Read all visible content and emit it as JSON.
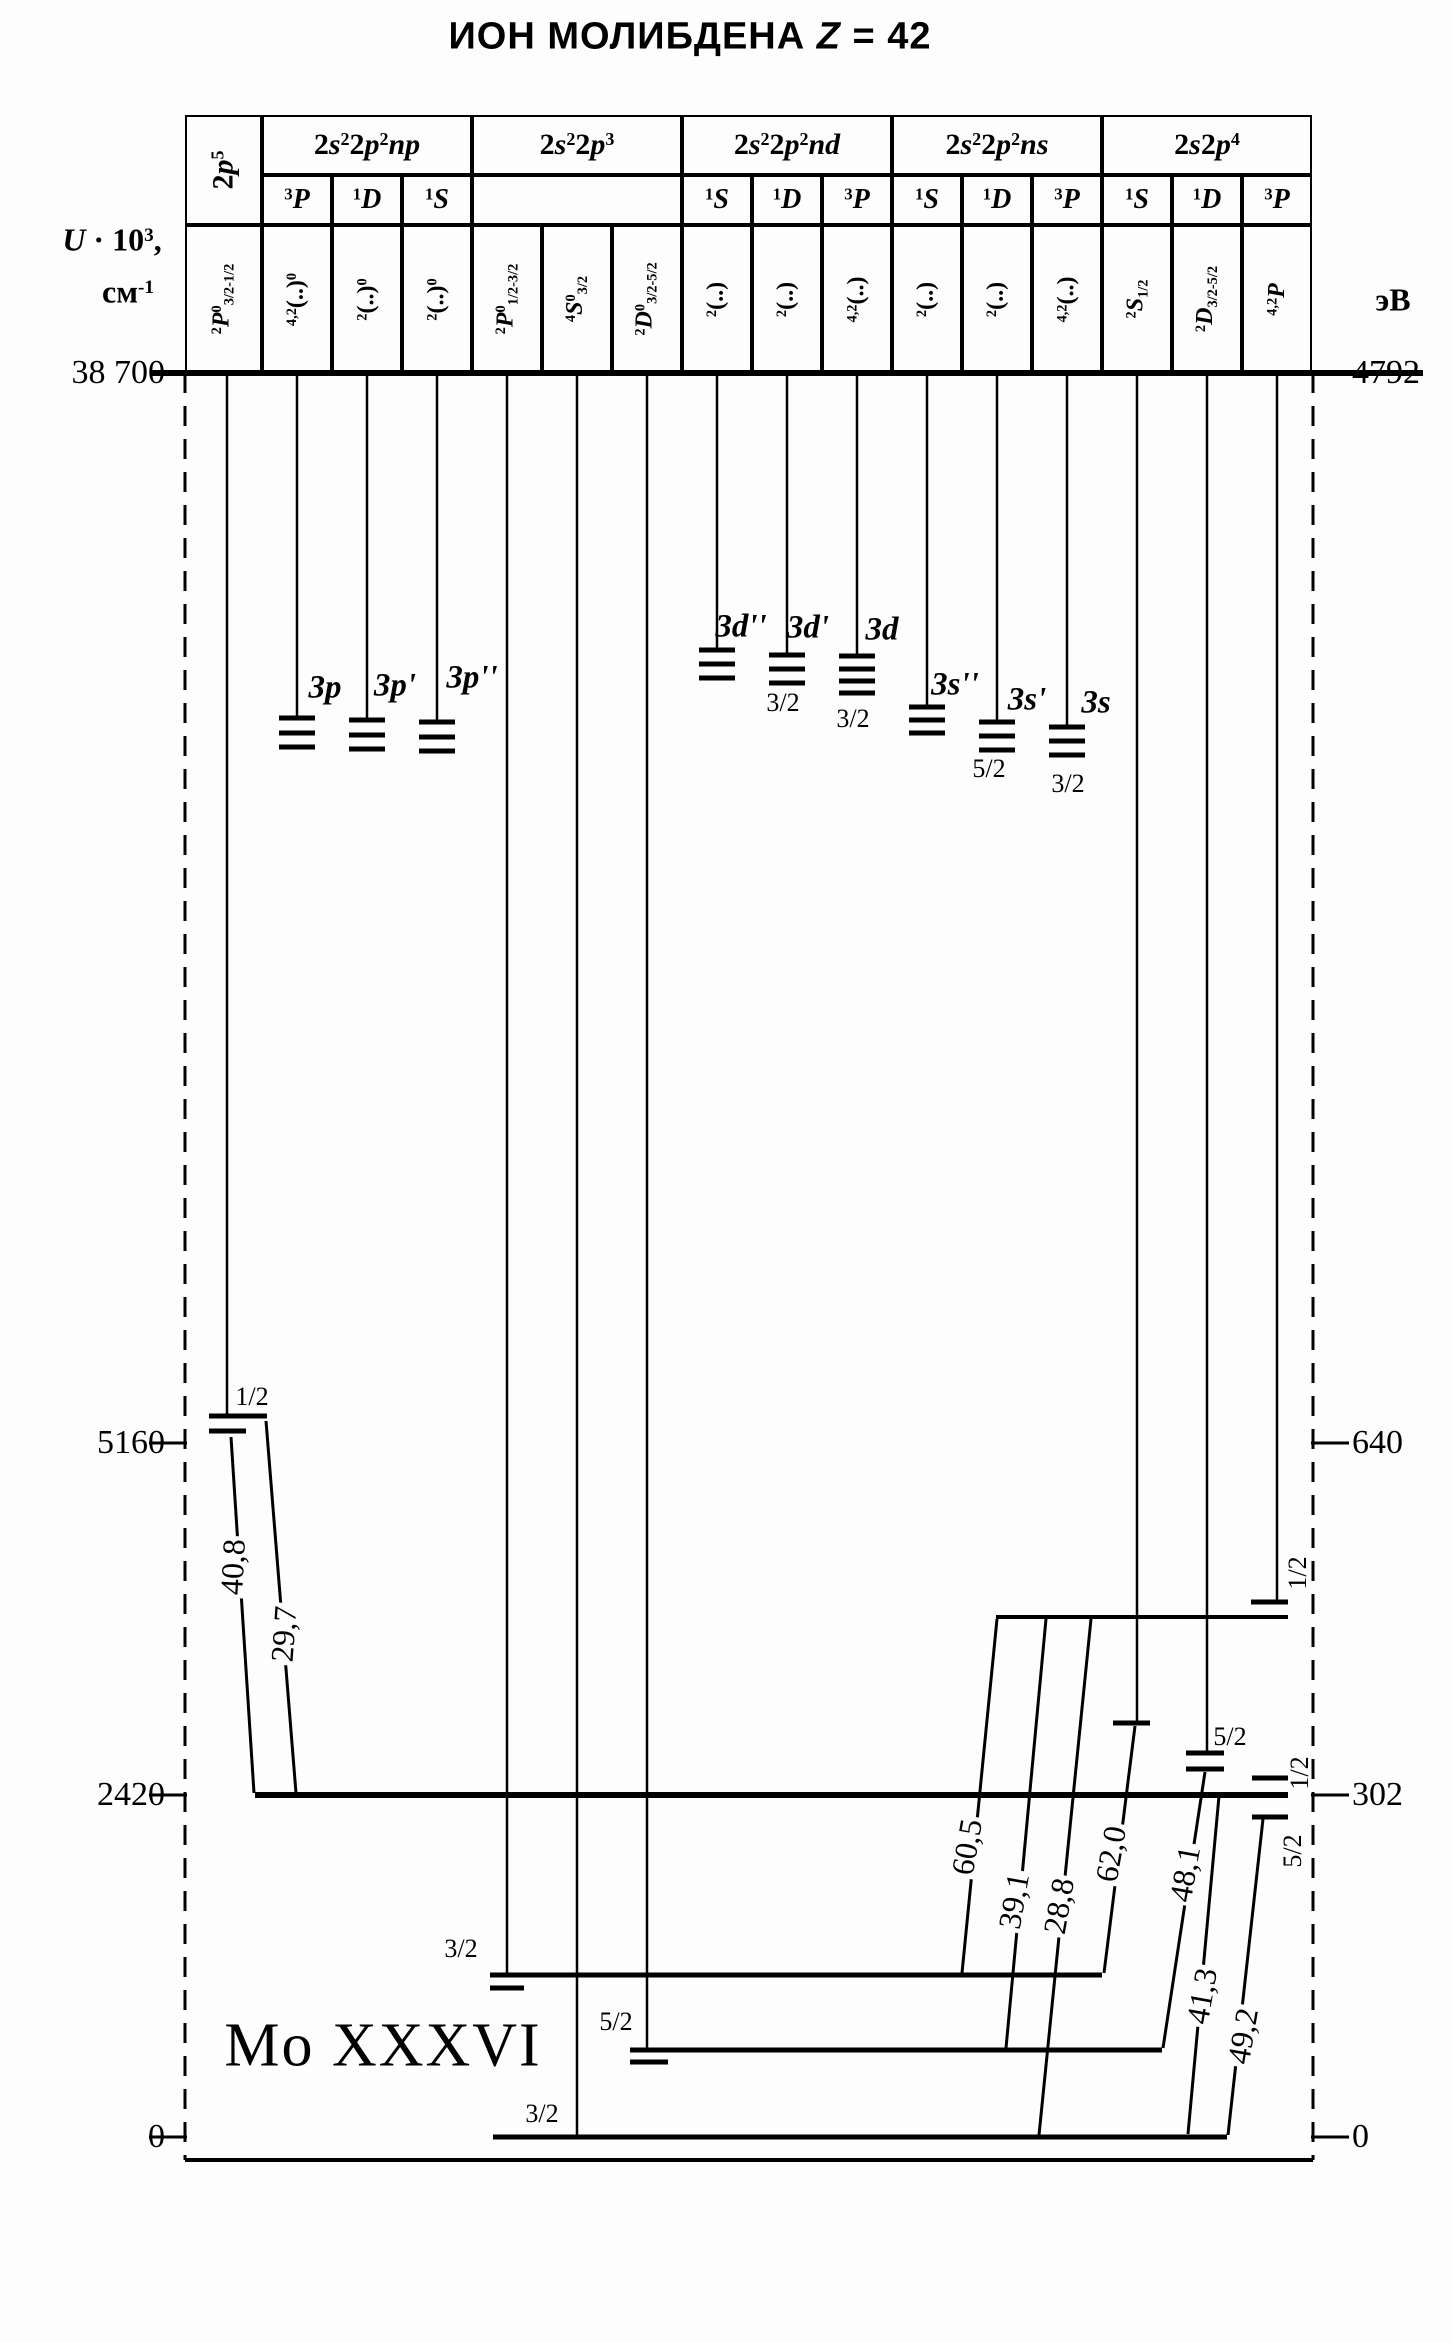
{
  "title_rich": "ИОН МОЛИБДЕНА  |*Z| = 42",
  "ion_label": "Mo XXXVI",
  "axes": {
    "left": {
      "unit_lines": [
        "*U| · 10|^3|,",
        "см|^-1"
      ],
      "ticks": [
        {
          "label": "38 700",
          "y": 373
        },
        {
          "label": "5160",
          "y": 1443
        },
        {
          "label": "2420",
          "y": 1795
        },
        {
          "label": "0",
          "y": 2137
        }
      ]
    },
    "right": {
      "unit": "эВ",
      "ticks": [
        {
          "label": "4792",
          "y": 373
        },
        {
          "label": "640",
          "y": 1443
        },
        {
          "label": "302",
          "y": 1795
        },
        {
          "label": "0",
          "y": 2137
        }
      ]
    }
  },
  "header": {
    "row_y": [
      115,
      175,
      225,
      373
    ],
    "cell_bounds": [
      185,
      262,
      332,
      402,
      472,
      542,
      612,
      682,
      752,
      822,
      892,
      962,
      1032,
      1102,
      1172,
      1242,
      1312
    ],
    "groups": [
      {
        "label": "2|*p|^5",
        "c0": 0,
        "c1": 0,
        "vertical": true
      },
      {
        "label": "2|*s|^2|2|*p|^2|*np",
        "c0": 1,
        "c1": 3
      },
      {
        "label": "2|*s|^2|2|*p|^3",
        "c0": 4,
        "c1": 6
      },
      {
        "label": "2|*s|^2|2|*p|^2|*nd",
        "c0": 7,
        "c1": 9
      },
      {
        "label": "2|*s|^2|2|*p|^2|*ns",
        "c0": 10,
        "c1": 12
      },
      {
        "label": "2|*s|2|*p|^4",
        "c0": 13,
        "c1": 15
      }
    ],
    "terms": [
      {
        "col": 1,
        "label": "^3|*P"
      },
      {
        "col": 2,
        "label": "^1|*D"
      },
      {
        "col": 3,
        "label": "^1|*S"
      },
      {
        "col": 7,
        "label": "^1|*S"
      },
      {
        "col": 8,
        "label": "^1|*D"
      },
      {
        "col": 9,
        "label": "^3|*P"
      },
      {
        "col": 10,
        "label": "^1|*S"
      },
      {
        "col": 11,
        "label": "^1|*D"
      },
      {
        "col": 12,
        "label": "^3|*P"
      },
      {
        "col": 13,
        "label": "^1|*S"
      },
      {
        "col": 14,
        "label": "^1|*D"
      },
      {
        "col": 15,
        "label": "^3|*P"
      }
    ],
    "merged_term_cell": {
      "c0": 4,
      "c1": 6
    },
    "col_labels": [
      "^2|*P|^0|_3/2-1/2",
      "^4,2|(..)|^0",
      "^2|(..)|^0",
      "^2|(..)|^0",
      "^2|*P|^0|_1/2-3/2",
      "^4|*S|^0|_3/2",
      "^2|*D|^0|_3/2-5/2",
      "^2|(..)",
      "^2|(..)",
      "^4,2|(..)",
      "^2|(..)",
      "^2|(..)",
      "^4,2|(..)",
      "^2|*S|_1/2",
      "^2|*D|_3/2-5/2",
      "^4,2|*P"
    ]
  },
  "frame": {
    "left_x": 185,
    "right_x": 1313,
    "baseline_y": 373,
    "baseline_x1": 150,
    "baseline_x2": 1423,
    "bottom_y": 2160,
    "tick_len": 36
  },
  "columns": {
    "x": [
      227,
      297,
      367,
      437,
      507,
      577,
      647,
      717,
      787,
      857,
      927,
      997,
      1067,
      1137,
      1207,
      1277
    ],
    "line_bottom": [
      1415,
      718,
      720,
      722,
      1975,
      2137,
      2050,
      650,
      655,
      656,
      707,
      722,
      727,
      1723,
      1753,
      1602
    ]
  },
  "levels": [
    {
      "x1": 209,
      "x2": 267,
      "y": 1416
    },
    {
      "x1": 209,
      "x2": 246,
      "y": 1431
    },
    {
      "x1": 279,
      "x2": 315,
      "y": 718
    },
    {
      "x1": 279,
      "x2": 315,
      "y": 733
    },
    {
      "x1": 279,
      "x2": 315,
      "y": 747
    },
    {
      "x1": 349,
      "x2": 385,
      "y": 720
    },
    {
      "x1": 349,
      "x2": 385,
      "y": 735
    },
    {
      "x1": 349,
      "x2": 385,
      "y": 749
    },
    {
      "x1": 419,
      "x2": 455,
      "y": 722
    },
    {
      "x1": 419,
      "x2": 455,
      "y": 737
    },
    {
      "x1": 419,
      "x2": 455,
      "y": 751
    },
    {
      "x1": 699,
      "x2": 735,
      "y": 650
    },
    {
      "x1": 699,
      "x2": 735,
      "y": 664
    },
    {
      "x1": 699,
      "x2": 735,
      "y": 678
    },
    {
      "x1": 769,
      "x2": 805,
      "y": 655
    },
    {
      "x1": 769,
      "x2": 805,
      "y": 669
    },
    {
      "x1": 769,
      "x2": 805,
      "y": 683
    },
    {
      "x1": 839,
      "x2": 875,
      "y": 656
    },
    {
      "x1": 839,
      "x2": 875,
      "y": 669
    },
    {
      "x1": 839,
      "x2": 875,
      "y": 681
    },
    {
      "x1": 839,
      "x2": 875,
      "y": 693
    },
    {
      "x1": 909,
      "x2": 945,
      "y": 707
    },
    {
      "x1": 909,
      "x2": 945,
      "y": 720
    },
    {
      "x1": 909,
      "x2": 945,
      "y": 733
    },
    {
      "x1": 979,
      "x2": 1015,
      "y": 722
    },
    {
      "x1": 979,
      "x2": 1015,
      "y": 736
    },
    {
      "x1": 979,
      "x2": 1015,
      "y": 750
    },
    {
      "x1": 1049,
      "x2": 1085,
      "y": 727
    },
    {
      "x1": 1049,
      "x2": 1085,
      "y": 741
    },
    {
      "x1": 1049,
      "x2": 1085,
      "y": 755
    },
    {
      "x1": 490,
      "x2": 1102,
      "y": 1975,
      "t": 5
    },
    {
      "x1": 490,
      "x2": 524,
      "y": 1988
    },
    {
      "x1": 493,
      "x2": 1227,
      "y": 2137,
      "t": 5
    },
    {
      "x1": 630,
      "x2": 1162,
      "y": 2050,
      "t": 5
    },
    {
      "x1": 630,
      "x2": 668,
      "y": 2062
    },
    {
      "x1": 1113,
      "x2": 1150,
      "y": 1723
    },
    {
      "x1": 1186,
      "x2": 1224,
      "y": 1753
    },
    {
      "x1": 1186,
      "x2": 1224,
      "y": 1769
    },
    {
      "x1": 1251,
      "x2": 1288,
      "y": 1602
    },
    {
      "x1": 996,
      "x2": 1288,
      "y": 1617,
      "t": 4
    },
    {
      "x1": 1252,
      "x2": 1288,
      "y": 1778
    },
    {
      "x1": 255,
      "x2": 1288,
      "y": 1795,
      "t": 6
    },
    {
      "x1": 1252,
      "x2": 1288,
      "y": 1817
    }
  ],
  "level_labels": [
    {
      "text": "1/2",
      "x": 252,
      "y": 1397
    },
    {
      "text": "3p",
      "x": 325,
      "y": 688,
      "italic": true
    },
    {
      "text": "3p'",
      "x": 395,
      "y": 686,
      "italic": true
    },
    {
      "text": "3p''",
      "x": 472,
      "y": 678,
      "italic": true
    },
    {
      "text": "3d''",
      "x": 741,
      "y": 627,
      "italic": true
    },
    {
      "text": "3d'",
      "x": 808,
      "y": 628,
      "italic": true
    },
    {
      "text": "3d",
      "x": 882,
      "y": 630,
      "italic": true
    },
    {
      "text": "3/2",
      "x": 783,
      "y": 703
    },
    {
      "text": "3/2",
      "x": 853,
      "y": 719
    },
    {
      "text": "3s''",
      "x": 955,
      "y": 685,
      "italic": true
    },
    {
      "text": "3s'",
      "x": 1027,
      "y": 700,
      "italic": true
    },
    {
      "text": "3s",
      "x": 1096,
      "y": 703,
      "italic": true
    },
    {
      "text": "5/2",
      "x": 989,
      "y": 769
    },
    {
      "text": "3/2",
      "x": 1068,
      "y": 784
    },
    {
      "text": "3/2",
      "x": 461,
      "y": 1949
    },
    {
      "text": "5/2",
      "x": 616,
      "y": 2022
    },
    {
      "text": "3/2",
      "x": 542,
      "y": 2114
    },
    {
      "text": "5/2",
      "x": 1230,
      "y": 1737
    },
    {
      "text": "1/2",
      "x": 1298,
      "y": 1573,
      "rot": -90
    },
    {
      "text": "1/2",
      "x": 1300,
      "y": 1773,
      "rot": -90
    },
    {
      "text": "5/2",
      "x": 1293,
      "y": 1851,
      "rot": -90
    }
  ],
  "transitions": [
    {
      "x1": 231,
      "y1": 1437,
      "x2": 254,
      "y2": 1793,
      "label": "40,8",
      "lx": 233,
      "ly": 1567,
      "rot": -87
    },
    {
      "x1": 266,
      "y1": 1421,
      "x2": 296,
      "y2": 1793,
      "label": "29,7",
      "lx": 284,
      "ly": 1634,
      "rot": -86
    },
    {
      "x1": 997,
      "y1": 1619,
      "x2": 962,
      "y2": 1973,
      "label": "60,5",
      "lx": 967,
      "ly": 1847,
      "rot": -80
    },
    {
      "x1": 1046,
      "y1": 1619,
      "x2": 1006,
      "y2": 2048,
      "label": "39,1",
      "lx": 1014,
      "ly": 1901,
      "rot": -80
    },
    {
      "x1": 1091,
      "y1": 1619,
      "x2": 1039,
      "y2": 2135,
      "label": "28,8",
      "lx": 1059,
      "ly": 1906,
      "rot": -80
    },
    {
      "x1": 1135,
      "y1": 1726,
      "x2": 1104,
      "y2": 1973,
      "label": "62,0",
      "lx": 1111,
      "ly": 1854,
      "rot": -80
    },
    {
      "x1": 1205,
      "y1": 1772,
      "x2": 1163,
      "y2": 2048,
      "label": "48,1",
      "lx": 1185,
      "ly": 1874,
      "rot": -80
    },
    {
      "x1": 1219,
      "y1": 1796,
      "x2": 1188,
      "y2": 2134,
      "label": "41,3",
      "lx": 1202,
      "ly": 1996,
      "rot": -80
    },
    {
      "x1": 1263,
      "y1": 1819,
      "x2": 1228,
      "y2": 2135,
      "label": "49,2",
      "lx": 1243,
      "ly": 2036,
      "rot": -80
    }
  ],
  "text_positions": {
    "title": {
      "x": 690,
      "y": 37
    },
    "ion_label": {
      "x": 383,
      "y": 2046
    },
    "unit_left1": {
      "x": 112,
      "y": 240
    },
    "unit_left2": {
      "x": 128,
      "y": 292
    },
    "unit_right": {
      "x": 1393,
      "y": 300
    }
  }
}
